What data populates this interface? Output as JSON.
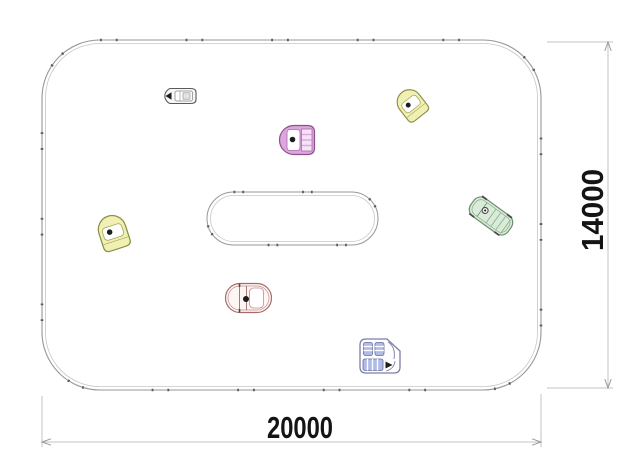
{
  "drawing": {
    "dimensions": {
      "width_label": "20000",
      "height_label": "14000"
    },
    "colors": {
      "background": "#ffffff",
      "boundary_line": "#979797",
      "boundary_inner_line": "#c6c6c6",
      "post_marks": "#5a5a5a",
      "dimension_line": "#c3c3c3",
      "dimension_arrow": "#9a9a9a",
      "dimension_text": "#141414",
      "grey_car_fill": "#f7f7f7",
      "grey_car_stroke": "#5a5a5a",
      "pink_car_fill": "#dda6dd",
      "pink_car_stroke": "#8d4f8d",
      "pink_car_detail": "#a66ba6",
      "yellow_car_fill": "#f0f0b2",
      "yellow_car_stroke": "#8f8f4a",
      "green_car_fill": "#d9ecd9",
      "green_car_stroke": "#6b8f6b",
      "green_car_detail": "#8aa88a",
      "red_car_fill": "#fdf6f3",
      "red_car_stroke": "#a56b6b",
      "red_car_detail": "#c09090",
      "purple_car_fill": "#ffffff",
      "purple_car_stroke": "#7d7da3",
      "purple_car_seat": "#b0bce6",
      "driver_dot": "#1d1d1d"
    },
    "vehicles": [
      {
        "name": "car-grey-top-left"
      },
      {
        "name": "car-pink-top-center"
      },
      {
        "name": "car-yellow-top-right"
      },
      {
        "name": "car-green-right"
      },
      {
        "name": "car-yellow-left"
      },
      {
        "name": "car-red-bottom-center"
      },
      {
        "name": "car-purple-bottom-right"
      }
    ]
  }
}
